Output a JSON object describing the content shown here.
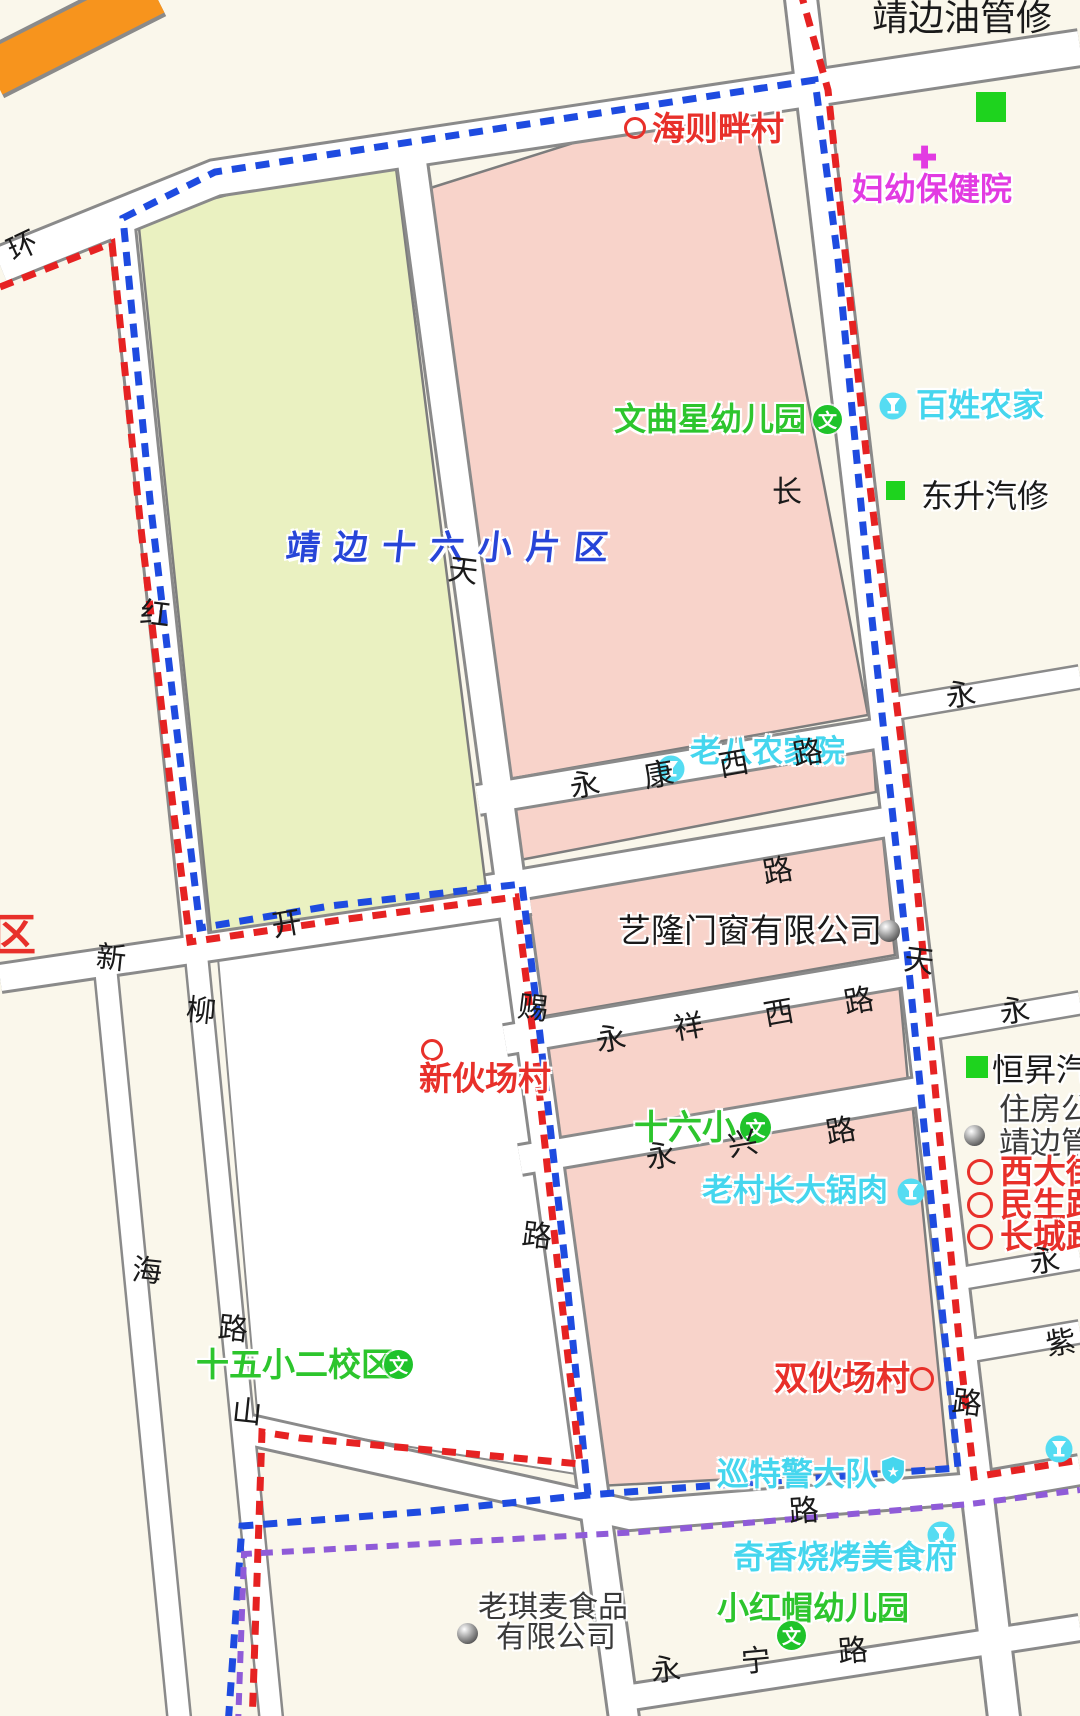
{
  "district": {
    "title": "靖边十六小片区"
  },
  "places": {
    "jingbian_oil": "靖边油管修",
    "haizeban": "海则畔村",
    "fuyou": "妇幼保健院",
    "wenquxing": "文曲星幼儿园",
    "baixing": "百姓农家",
    "dongsheng": "东升汽修",
    "laoba": "老八农家院",
    "yilong": "艺隆门窗有限公司",
    "xinhuochang": "新伙场村",
    "hengsheng": "恒昇汽",
    "zhufang1": "住房公",
    "zhufang2": "靖边管",
    "xidajie": "西大街",
    "minsheng": "民生路",
    "changcheng": "长城路",
    "shiliuxiao": "十六小",
    "laocunzhang": "老村长大锅肉",
    "shiwuxiao": "十五小二校区",
    "shuanghuochang": "双伙场村",
    "xunte": "巡特警大队",
    "qixiang": "奇香烧烤美食府",
    "xiaohongmao": "小红帽幼儿园",
    "laoqimai1": "老琪麦食品",
    "laoqimai2": "有限公司",
    "qu": "区"
  },
  "road_names": {
    "yongkang": [
      "永",
      "康",
      "西",
      "路"
    ],
    "yongxiang": [
      "永",
      "祥",
      "西",
      "路"
    ],
    "yongxing": [
      "永",
      "兴",
      "路"
    ],
    "yongning": [
      "永",
      "宁",
      "路"
    ],
    "huan": "环",
    "hong": "红",
    "tian_mid": "天",
    "ci": "赐",
    "lu_r4": "路",
    "kai": "开",
    "liu": "柳",
    "xin": "新",
    "hai": "海",
    "lu_r6b": "路",
    "shan": "山",
    "chang": "长",
    "tian_right": "天",
    "lu_r3": "路",
    "lu_r7": "路",
    "lu_hb": "路",
    "yong_r1": "永",
    "yong_r2": "永",
    "yong_r3": "永",
    "zi": "紫"
  },
  "icons": {
    "school_badge": "文",
    "hospital_cross": "✚",
    "star": "★"
  },
  "colors": {
    "boundary_blue": "#1E4BE0",
    "boundary_red": "#E62222",
    "boundary_purple": "#8F5BD8",
    "zone_green": "#EAF1C1",
    "zone_pink": "#F8D3CA",
    "road_orange": "#F7941D",
    "label_red": "#E8302A",
    "label_green": "#2DC52D",
    "label_cyan": "#45D6EE",
    "label_magenta": "#E23BE2",
    "title_blue": "#2745D8",
    "background": "#FAF7EB"
  }
}
